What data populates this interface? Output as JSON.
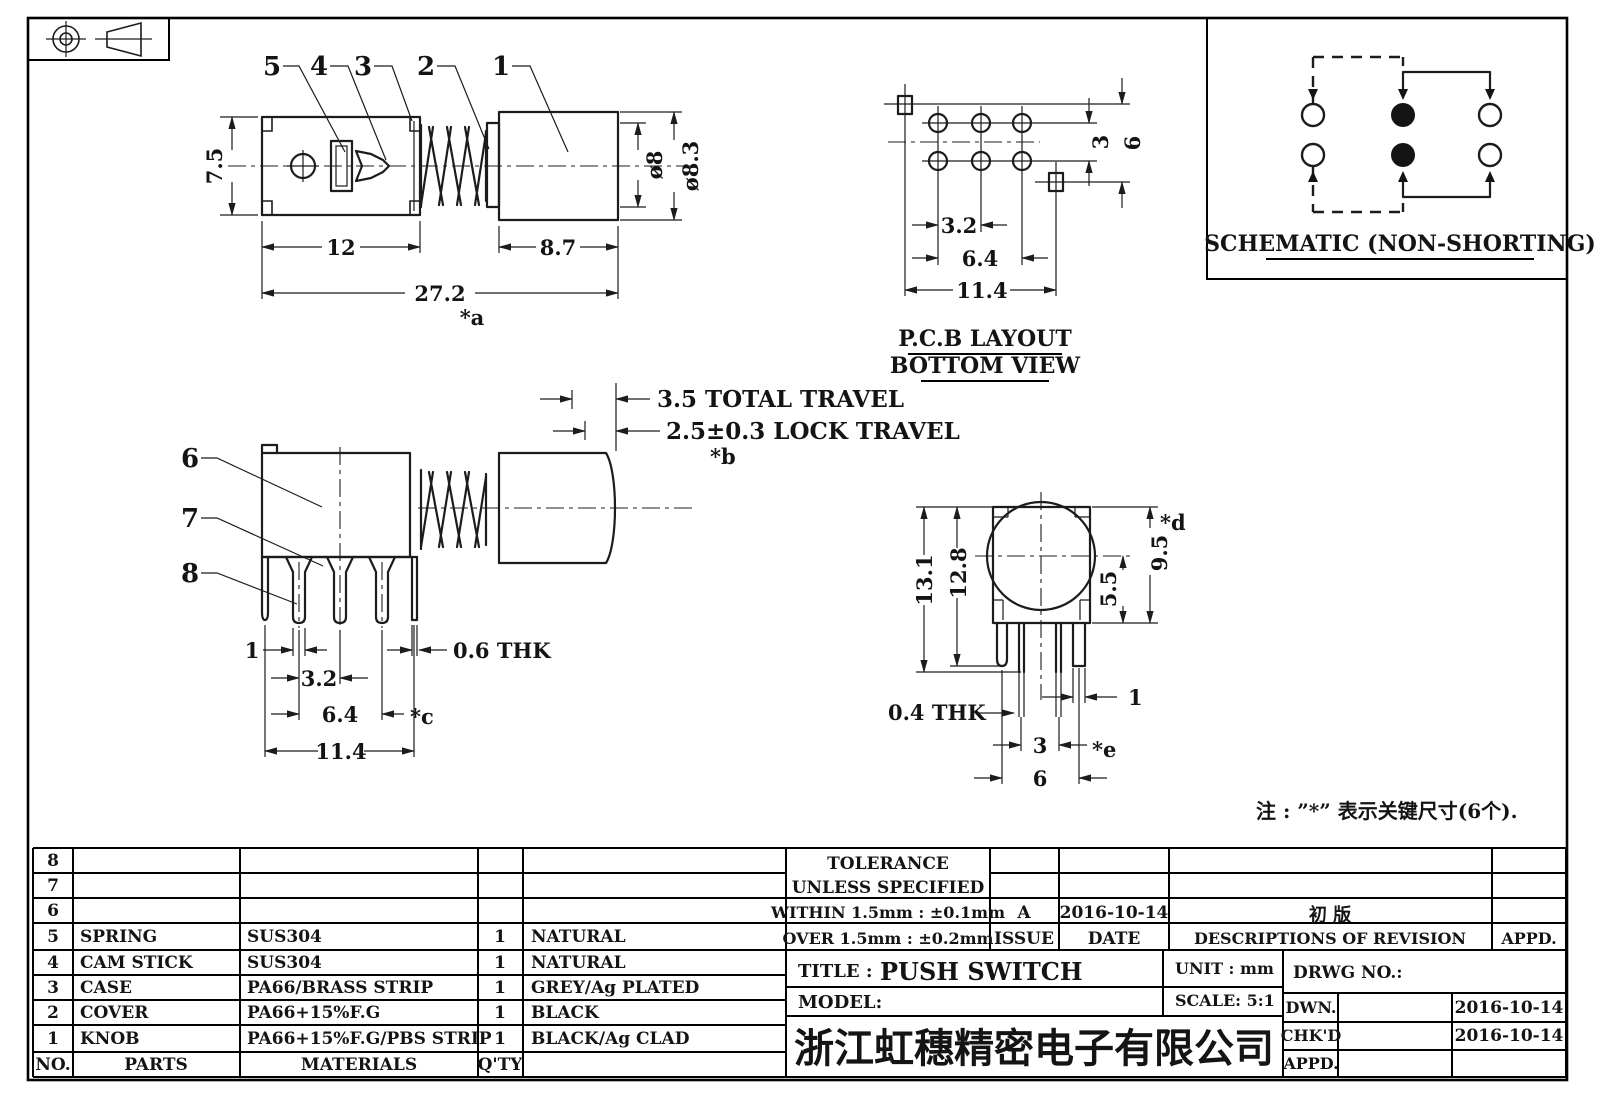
{
  "view_a": {
    "part_labels": [
      "5",
      "4",
      "3",
      "2",
      "1"
    ],
    "dim_height": "7.5",
    "dim_body_len": "12",
    "dim_knob_len": "8.7",
    "dim_total_len": "27.2",
    "key_a": "*a",
    "dia_inner": "ø8",
    "dia_outer": "ø8.3"
  },
  "pcb_layout": {
    "caption_line1": "P.C.B LAYOUT",
    "caption_line2": "BOTTOM VIEW",
    "dim_pitch": "3.2",
    "dim_span": "6.4",
    "dim_width": "11.4",
    "dim_row_gap": "3",
    "dim_row_span": "6"
  },
  "schematic": {
    "caption": "SCHEMATIC (NON-SHORTING)"
  },
  "view_b": {
    "part_labels": [
      "6",
      "7",
      "8"
    ],
    "dim_total_travel": "3.5 TOTAL TRAVEL",
    "dim_lock_travel": "2.5±0.3 LOCK TRAVEL",
    "key_b": "*b",
    "dim_pin_width": "1",
    "dim_pitch": "3.2",
    "dim_span": "6.4",
    "key_c": "*c",
    "dim_width": "11.4",
    "dim_thickness": "0.6 THK"
  },
  "view_c": {
    "dim_total_height": "13.1",
    "dim_body_height": "12.8",
    "dim_upper_height": "9.5",
    "key_d": "*d",
    "dim_lower_height": "5.5",
    "dim_thickness": "0.4 THK",
    "dim_pin_width": "1",
    "dim_pitch": "3",
    "key_e": "*e",
    "dim_span": "6"
  },
  "note": {
    "text": "注 : ”*” 表示关键尺寸(6个)."
  },
  "parts_table": {
    "header": {
      "no": "NO.",
      "parts": "PARTS",
      "materials": "MATERIALS",
      "qty": "Q'TY"
    },
    "rows": [
      {
        "no": "8",
        "parts": "",
        "materials": "",
        "qty": "",
        "color": ""
      },
      {
        "no": "7",
        "parts": "",
        "materials": "",
        "qty": "",
        "color": ""
      },
      {
        "no": "6",
        "parts": "",
        "materials": "",
        "qty": "",
        "color": ""
      },
      {
        "no": "5",
        "parts": "SPRING",
        "materials": "SUS304",
        "qty": "1",
        "color": "NATURAL"
      },
      {
        "no": "4",
        "parts": "CAM STICK",
        "materials": "SUS304",
        "qty": "1",
        "color": "NATURAL"
      },
      {
        "no": "3",
        "parts": "CASE",
        "materials": "PA66/BRASS STRIP",
        "qty": "1",
        "color": "GREY/Ag PLATED"
      },
      {
        "no": "2",
        "parts": "COVER",
        "materials": "PA66+15%F.G",
        "qty": "1",
        "color": "BLACK"
      },
      {
        "no": "1",
        "parts": "KNOB",
        "materials": "PA66+15%F.G/PBS STRIP",
        "qty": "1",
        "color": "BLACK/Ag CLAD"
      }
    ]
  },
  "title_block": {
    "tolerance_title": "TOLERANCE",
    "tolerance_subtitle": "UNLESS  SPECIFIED",
    "within_rule": "WITHIN 1.5mm : ±0.1mm",
    "over_rule": "OVER 1.5mm : ±0.2mm",
    "issue_value": "A",
    "issue_label": "ISSUE",
    "date_value": "2016-10-14",
    "date_label": "DATE",
    "revision_value": "初  版",
    "revision_label": "DESCRIPTIONS OF REVISION",
    "appd_label": "APPD.",
    "title_label": "TITLE :",
    "title_value": "PUSH SWITCH",
    "model_label": "MODEL:",
    "unit_label": "UNIT :  mm",
    "scale_label": "SCALE:  5:1",
    "drwg_label": "DRWG NO.:",
    "dwn_label": "DWN.",
    "dwn_date": "2016-10-14",
    "chkd_label": "CHK'D",
    "chkd_date": "2016-10-14",
    "appd_row_label": "APPD.",
    "company": "浙江虹穗精密电子有限公司"
  }
}
